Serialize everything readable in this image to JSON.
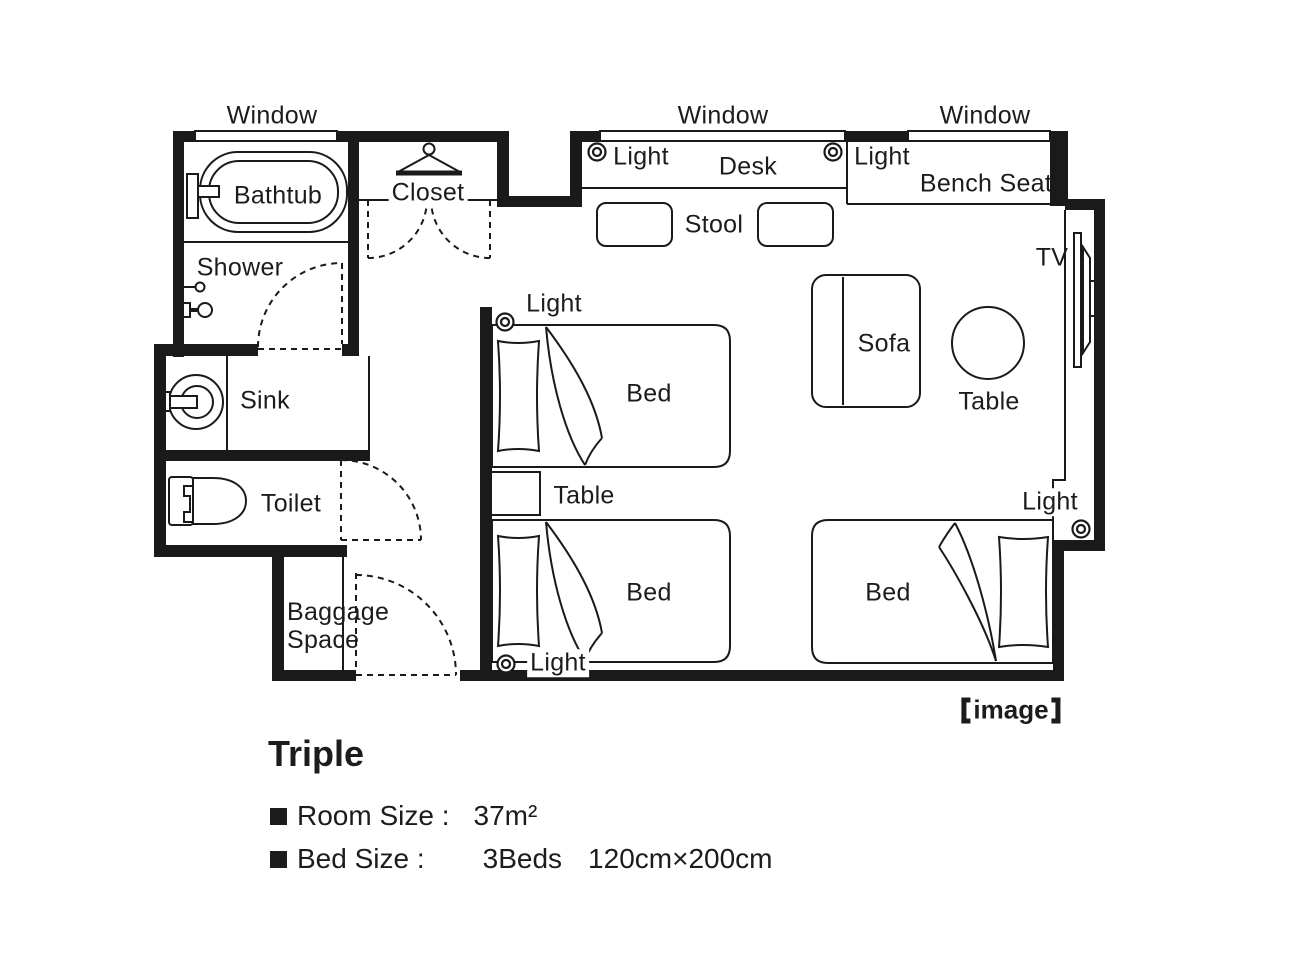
{
  "colors": {
    "ink": "#1a1a1a",
    "paper": "#ffffff"
  },
  "icons": {
    "light": "double-circle-ceiling-light",
    "hanger": "clothes-hanger",
    "door": "dashed-quarter-arc-swing"
  },
  "plan": {
    "labels": {
      "window_left": "Window",
      "window_middle": "Window",
      "window_right": "Window",
      "light_desk_left": "Light",
      "light_desk_right": "Light",
      "light_bed_top": "Light",
      "light_bed_bottom": "Light",
      "light_wall": "Light",
      "desk": "Desk",
      "stool": "Stool",
      "bench_seat": "Bench Seat",
      "closet": "Closet",
      "bathtub": "Bathtub",
      "shower": "Shower",
      "sink": "Sink",
      "toilet": "Toilet",
      "tv": "TV",
      "sofa": "Sofa",
      "table_round": "Table",
      "table_night": "Table",
      "bed_top": "Bed",
      "bed_bottom": "Bed",
      "bed_right": "Bed",
      "baggage_line1": "Baggage",
      "baggage_line2": "Space"
    },
    "caption": {
      "text": "image",
      "full": "【image】"
    }
  },
  "info": {
    "room_type": "Triple",
    "room_size_label": "Room Size :",
    "room_size_value": "37m²",
    "bed_size_label": "Bed Size :",
    "bed_count": "3Beds",
    "bed_dimensions": "120cm×200cm"
  }
}
